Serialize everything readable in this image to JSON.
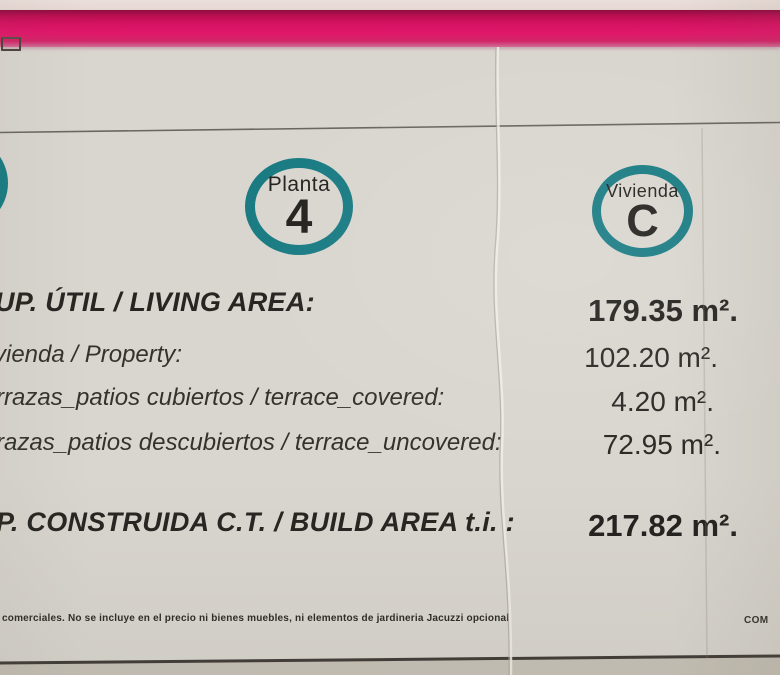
{
  "badges": {
    "planta": {
      "label": "Planta",
      "value": "4"
    },
    "vivienda": {
      "label": "Vivienda",
      "value": "C"
    }
  },
  "areas": {
    "rows": [
      {
        "label": "UP. ÚTIL / LIVING AREA:",
        "value": "179.35 m².",
        "emphasis": "bold"
      },
      {
        "label": "vienda / Property:",
        "value": "102.20 m².",
        "emphasis": "regular"
      },
      {
        "label": "rrazas_patios cubiertos / terrace_covered:",
        "value": "4.20 m².",
        "emphasis": "regular"
      },
      {
        "label": "razas_patios descubiertos / terrace_uncovered:",
        "value": "72.95 m².",
        "emphasis": "regular"
      },
      {
        "label": "P. CONSTRUIDA C.T. / BUILD AREA t.i. :",
        "value": "217.82 m².",
        "emphasis": "bold"
      }
    ]
  },
  "footer": {
    "disclaimer": "comerciales. No se incluye en el precio ni bienes muebles, ni elementos de jardineria Jacuzzi opcional",
    "right_text": "COM"
  },
  "colors": {
    "stripe_pink": "#d8145f",
    "ring_teal": "#1a7b83",
    "paper": "#d9d6cf",
    "ink": "#2c2a26"
  }
}
